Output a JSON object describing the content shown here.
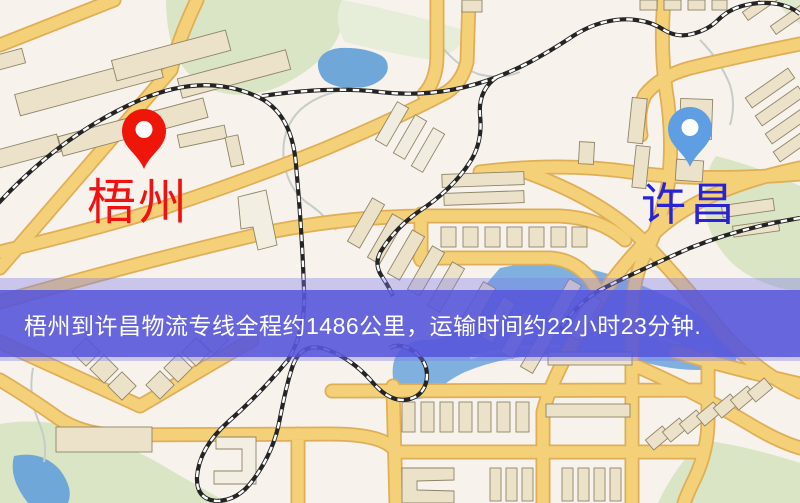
{
  "map": {
    "origin_marker": {
      "label": "梧州",
      "pin_color": "#ee1509",
      "label_color": "#f21111"
    },
    "destination_marker": {
      "label": "许昌",
      "pin_color": "#5f9ee3",
      "label_color": "#2a23d4"
    },
    "info_banner": {
      "text": "梧州到许昌物流专线全程约1486公里，运输时间约22小时23分钟.",
      "background_color": "#5553da",
      "text_color": "#ffffff"
    },
    "style_colors": {
      "background": "#f7f2ec",
      "road_fill": "#f4d078",
      "road_casing": "#dfae57",
      "park": "#d9e5c4",
      "water": "#6fa7d8",
      "railway": "#242424",
      "building": "#ebe2c9"
    }
  }
}
